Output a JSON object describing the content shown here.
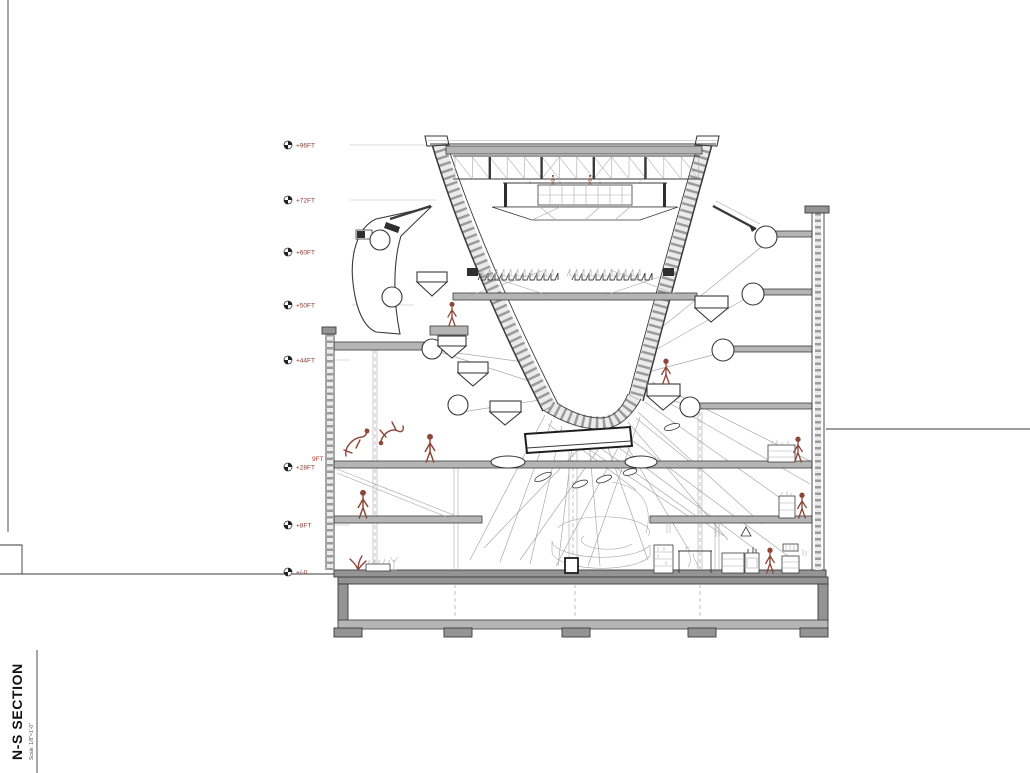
{
  "title_block": {
    "title": "N-S SECTION",
    "scale_note": "Scale: 1/8\"=1'-0\""
  },
  "elevation_markers": [
    {
      "label": "+96FT"
    },
    {
      "label": "+72FT"
    },
    {
      "label": "+60FT"
    },
    {
      "label": "+50FT"
    },
    {
      "label": "+44FT"
    },
    {
      "label": "+28FT"
    },
    {
      "label": "+8FT"
    },
    {
      "label": "+/-0"
    }
  ],
  "annotations": {
    "left_wall_dimension": "9FT"
  },
  "colors": {
    "paper": "#ffffff",
    "line": "#3a3a3a",
    "thin": "#a9a9a9",
    "leader": "#cfcfcf",
    "slab": "#b5b5b5",
    "slab_dark": "#949494",
    "band": "#ebebeb",
    "rung": "#9b9b9b",
    "figure": "#8d4637",
    "label": "#8a3a32",
    "dimension": "#c0392b"
  }
}
